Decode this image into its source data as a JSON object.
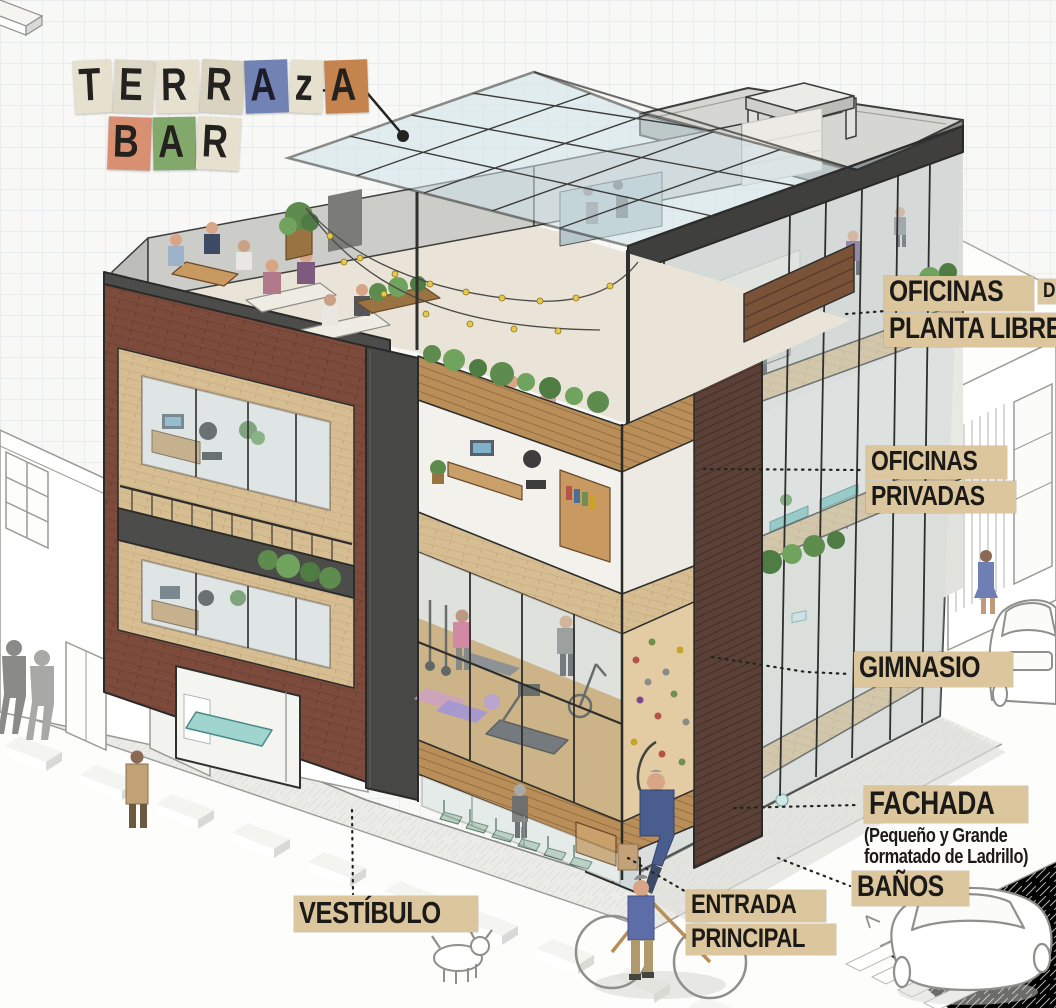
{
  "labels": {
    "terraza_bar": {
      "rows": [
        [
          {
            "ch": "T",
            "bg": "#e6e0cf"
          },
          {
            "ch": "E",
            "bg": "#ddd7c5"
          },
          {
            "ch": "R",
            "bg": "#e6e0cf"
          },
          {
            "ch": "R",
            "bg": "#d9d3c0"
          },
          {
            "ch": "A",
            "bg": "#7282b4"
          },
          {
            "ch": "z",
            "bg": "#e6e0cf"
          },
          {
            "ch": "A",
            "bg": "#c5834e"
          }
        ],
        [
          {
            "ch": "B",
            "bg": "#d98f72"
          },
          {
            "ch": "A",
            "bg": "#83a86b"
          },
          {
            "ch": "R",
            "bg": "#e6e0cf"
          }
        ]
      ]
    },
    "oficinas_planta_libre": {
      "line1": "OFICINAS",
      "line1_suffix": "DE",
      "line2": "PLANTA LIBRE"
    },
    "oficinas_privadas": {
      "line1": "OFICINAS",
      "line2": "PRIVADAS"
    },
    "gimnasio": {
      "text": "GIMNASIO"
    },
    "fachada": {
      "title": "FACHADA",
      "subtitle_line1": "(Pequeño y Grande",
      "subtitle_line2": "formatado de Ladrillo)"
    },
    "banos": {
      "text": "BAÑOS"
    },
    "vestibulo": {
      "text": "VESTÍBULO"
    },
    "entrada_principal": {
      "line1": "ENTRADA",
      "line2": "PRINCIPAL"
    }
  },
  "palette": {
    "label_background": "#dcc69e",
    "ink": "#1e1d1a",
    "paper": "#f8f9f6",
    "grid_line": "#dde3e7",
    "brick_dark": "#7d4b3c",
    "brick_tan": "#d2b185",
    "wood": "#c89a62",
    "dark_frame": "#3f3f3f",
    "glass": "#d7e0e2",
    "canopy_glass": "#cfe2e8",
    "plant_green": "#5e8c4e",
    "chair_green": "#b8cfc0",
    "teal_fixture": "#8fd0ca"
  }
}
